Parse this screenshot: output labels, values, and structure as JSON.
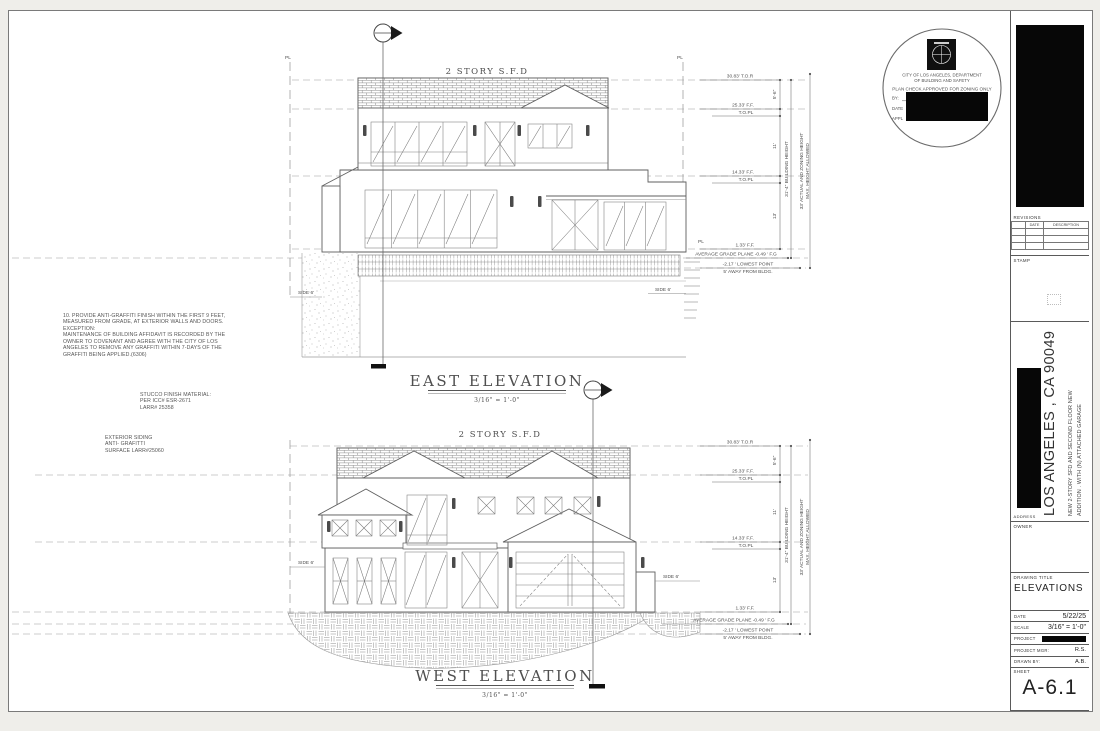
{
  "colors": {
    "line": "#5f5f5f",
    "redaction": "#070707",
    "dash": "#b9b9b9"
  },
  "annotations": {
    "pl": "PL",
    "side_6": "SIDE 6'",
    "story_label": "2 STORY S.F.D"
  },
  "levels": {
    "tor": "30.83' T.O.R",
    "ff_25": "25.33' F.F.",
    "topl": "T.O.PL",
    "ff_14": "14.33' F.F.",
    "ff_1": "1.33' F.F.",
    "avg_grade": "AVERAGE GRADE PLANE -0.49 ' F.G",
    "lowest_point": "-2.17 ' LOWEST POINT",
    "away_from_bldg": "5' AWAY FROM BLDG.",
    "h_5_6": "5'-6\"",
    "h_11": "11'",
    "h_13": "13'",
    "bldg_height": "31'-4\" BUILDING HEIGHT",
    "zoning_height_1": "33' ACTUAL AND ZONING HEIGHT",
    "zoning_height_2": "MAX. HEIGHT ALLOWED"
  },
  "east": {
    "title": "EAST ELEVATION",
    "scale": "3/16\" = 1'-0\""
  },
  "west": {
    "title": "WEST ELEVATION",
    "scale": "3/16\" = 1'-0\""
  },
  "notes": {
    "anti_graffiti": "10. PROVIDE ANTI-GRAFFITI FINISH WITHIN THE FIRST 9 FEET,\nMEASURED FROM GRADE, AT EXTERIOR WALLS AND DOORS.\nEXCEPTION:\nMAINTENANCE OF BUILDING AFFIDAVIT IS RECORDED BY THE\nOWNER TO COVENANT AND AGREE WITH THE CITY OF LOS\nANGELES TO REMOVE ANY GRAFFITI WITHIN 7-DAYS OF THE\nGRAFFITI BEING APPLIED.(6306)",
    "stucco": "STUCCO FINISH MATERIAL:\nPER ICC# ESR-2671\nLARR# 25358",
    "siding": "EXTERIOR SIDING\nANTI- GRAFITTI\nSURFACE LARR#25060"
  },
  "approval_stamp": {
    "line1": "CITY OF LOS ANGELES, DEPARTMENT",
    "line2": "OF BUILDING AND SAFETY",
    "line3": "PLAN CHECK APPROVED FOR ZONING ONLY",
    "by_label": "BY:",
    "date_label": "DATE",
    "appl_label": "APPL"
  },
  "titleblock": {
    "revisions_label": "REVISIONS",
    "revisions_date_col": "DATE",
    "revisions_desc_col": "DESCRIPTION",
    "stamp_label": "STAMP",
    "address_label": "ADDRESS",
    "address_city": "LOS ANGELES , CA 90049",
    "project_desc_line1": "NEW 2-STORY SFD AND SECOND FLOOR NEW",
    "project_desc_line2": "ADDITION . WITH (N) ATTACHED GARAGE",
    "owner_label": "OWNER",
    "drawing_title_label": "DRAWING TITLE",
    "drawing_title": "ELEVATIONS",
    "date_label": "DATE",
    "date_value": "5/22/25",
    "scale_label": "SCALE",
    "scale_value": "3/16\" = 1'-0\"",
    "project_label": "PROJECT",
    "project_mgr_label": "PROJECT MGR:",
    "project_mgr_value": "R.S.",
    "drawn_by_label": "DRAWN BY:",
    "drawn_by_value": "A.B.",
    "sheet_label": "SHEET",
    "sheet_number": "A-6.1"
  }
}
